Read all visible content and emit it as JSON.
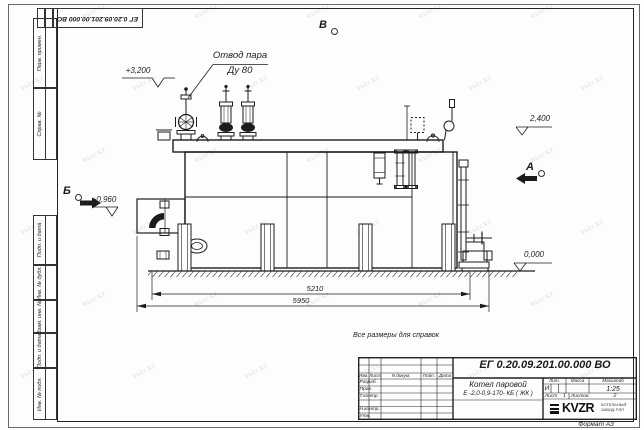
{
  "watermark": {
    "text": "kvzr.kz"
  },
  "frame": {
    "corner_doc_number": "ЕГ 0.20.09.201.00.000  ВО",
    "left_stamps": [
      "Перв. примен.",
      "Справ. №",
      "Подп. и дата",
      "Инв. № дубл.",
      "Взам. инв. №",
      "Подп. и дата",
      "Инв. № подл."
    ],
    "format_label": "Формат А3"
  },
  "drawing": {
    "note": "Все размеры для справок",
    "callout_line1": "Отвод пара",
    "callout_line2": "Ду 80",
    "view_b": "Б",
    "view_v": "В",
    "view_a": "А",
    "elev_3200": "+3,200",
    "elev_2400": "2,400",
    "elev_0960": "+0,960",
    "elev_0000": "0,000",
    "dim_inner": "5210",
    "dim_outer": "5950"
  },
  "title_block": {
    "doc_number": "ЕГ 0.20.09.201.00.000  ВО",
    "product_line1": "Котел паровой",
    "product_line2": "Е -2,0-0,9-170- КБ ( ЖК )",
    "col_izm": "Изм.",
    "col_list": "Лист",
    "col_ndoc": "N докум.",
    "col_podp": "Подп.",
    "col_data": "Дата",
    "row_razrab": "Разраб.",
    "row_prov": "Пров.",
    "row_tkontr": "Т.контр.",
    "row_nkontr": "Н.контр.",
    "row_utv": "Утв.",
    "lit_label": "Лит.",
    "lit_value": "И",
    "mass_label": "Масса",
    "scale_label": "Масштаб",
    "scale_value": "1:25",
    "sheet_label": "Лист",
    "sheet_value": "1",
    "sheets_label": "Листов",
    "sheets_value": "2",
    "logo_text": "KVZR",
    "company_line1": "КОТЕЛЬНЫЙ",
    "company_line2": "ЗАВОД РЭП"
  }
}
